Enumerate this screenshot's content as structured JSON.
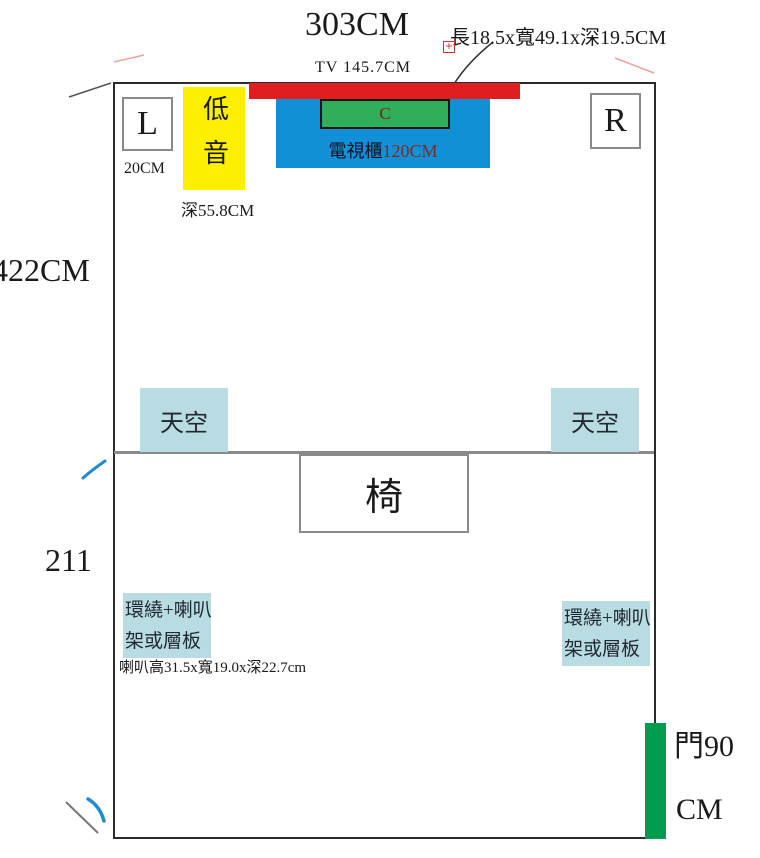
{
  "colors": {
    "tv_red": "#e01d20",
    "cabinet_blue": "#1190d8",
    "center_green": "#2fae5c",
    "subwoofer_yellow": "#fcf000",
    "ceiling_blue": "#b9dbe2",
    "door_green": "#009c4e",
    "wall_black": "#2b2b2b",
    "divider_gray": "#8a8a8a",
    "leader_red": "#b03a2e",
    "corner_pink": "#e9a2a2",
    "mark_blue": "#1d8bd4"
  },
  "diagram": {
    "title": "303CM",
    "annotations": {
      "center_speaker_dims": "長18.5x寬49.1x深19.5CM",
      "tv_width": "TV 145.7CM",
      "front_wall_gap": "20CM",
      "subwoofer_depth": "深55.8CM",
      "room_length_front": "422CM",
      "room_length_rear": "211",
      "speaker_dims": "喇叭高31.5x寬19.0x深22.7cm",
      "door_width_line1": "門90",
      "door_width_line2": "CM"
    },
    "objects": {
      "front_left_speaker": "L",
      "front_right_speaker": "R",
      "subwoofer": "低音",
      "center_speaker": "C",
      "tv_cabinet_name": "電視櫃",
      "tv_cabinet_size": "120CM",
      "ceiling_speaker_left": "天空",
      "ceiling_speaker_right": "天空",
      "chair": "椅",
      "surround_left_line1": "環繞+喇叭",
      "surround_left_line2": "架或層板",
      "surround_right_line1": "環繞+喇叭",
      "surround_right_line2": "架或層板"
    },
    "anchor_icon_glyph": "+"
  }
}
